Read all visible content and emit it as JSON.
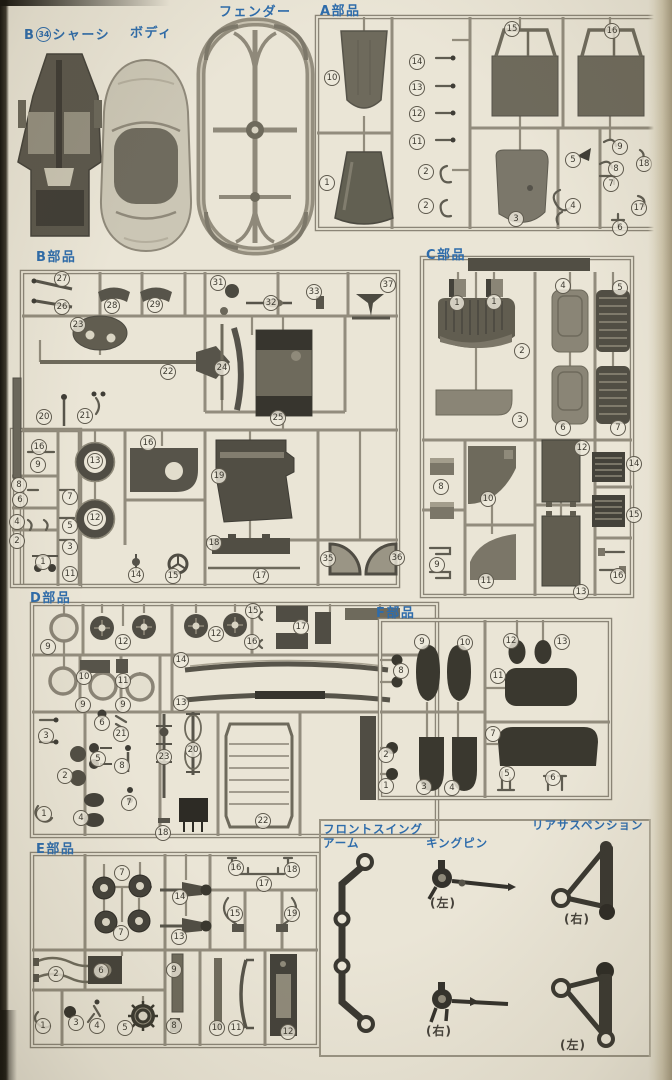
{
  "colors": {
    "paper": "#eae5d6",
    "runner": "#8b8577",
    "part_dark": "#4f4c44",
    "part_mid": "#767265",
    "label_blue": "#2e6cab",
    "caption_ink": "#45413a"
  },
  "header": {
    "chassis_prefix": "B",
    "chassis_number": "34",
    "chassis_name": "シャーシ",
    "body_label": "ボディ",
    "fender_label": "フェンダー"
  },
  "sections": [
    {
      "id": "A",
      "label": "A部品",
      "parts": [
        {
          "n": "10",
          "x": 332,
          "y": 78
        },
        {
          "n": "1",
          "x": 327,
          "y": 183
        },
        {
          "n": "14",
          "x": 417,
          "y": 62
        },
        {
          "n": "13",
          "x": 417,
          "y": 88
        },
        {
          "n": "12",
          "x": 417,
          "y": 114
        },
        {
          "n": "11",
          "x": 417,
          "y": 142
        },
        {
          "n": "2",
          "x": 426,
          "y": 172
        },
        {
          "n": "2",
          "x": 426,
          "y": 206
        },
        {
          "n": "15",
          "x": 512,
          "y": 29
        },
        {
          "n": "16",
          "x": 612,
          "y": 31
        },
        {
          "n": "3",
          "x": 516,
          "y": 219
        },
        {
          "n": "5",
          "x": 573,
          "y": 160
        },
        {
          "n": "9",
          "x": 620,
          "y": 147
        },
        {
          "n": "8",
          "x": 616,
          "y": 169
        },
        {
          "n": "18",
          "x": 644,
          "y": 164
        },
        {
          "n": "7",
          "x": 611,
          "y": 184
        },
        {
          "n": "4",
          "x": 573,
          "y": 206
        },
        {
          "n": "17",
          "x": 639,
          "y": 208
        },
        {
          "n": "6",
          "x": 620,
          "y": 228
        }
      ]
    },
    {
      "id": "B",
      "label": "B部品",
      "parts": [
        {
          "n": "27",
          "x": 62,
          "y": 279
        },
        {
          "n": "26",
          "x": 62,
          "y": 307
        },
        {
          "n": "28",
          "x": 112,
          "y": 306
        },
        {
          "n": "29",
          "x": 155,
          "y": 305
        },
        {
          "n": "31",
          "x": 218,
          "y": 283
        },
        {
          "n": "32",
          "x": 271,
          "y": 303
        },
        {
          "n": "33",
          "x": 314,
          "y": 292
        },
        {
          "n": "37",
          "x": 388,
          "y": 285
        },
        {
          "n": "23",
          "x": 78,
          "y": 325
        },
        {
          "n": "22",
          "x": 168,
          "y": 372
        },
        {
          "n": "24",
          "x": 222,
          "y": 368
        },
        {
          "n": "25",
          "x": 278,
          "y": 418
        },
        {
          "n": "20",
          "x": 44,
          "y": 417
        },
        {
          "n": "21",
          "x": 85,
          "y": 416
        },
        {
          "n": "16",
          "x": 39,
          "y": 447
        },
        {
          "n": "9",
          "x": 38,
          "y": 465
        },
        {
          "n": "8",
          "x": 19,
          "y": 485
        },
        {
          "n": "6",
          "x": 20,
          "y": 500
        },
        {
          "n": "4",
          "x": 17,
          "y": 522
        },
        {
          "n": "2",
          "x": 17,
          "y": 541
        },
        {
          "n": "1",
          "x": 43,
          "y": 562
        },
        {
          "n": "7",
          "x": 70,
          "y": 497
        },
        {
          "n": "5",
          "x": 70,
          "y": 526
        },
        {
          "n": "3",
          "x": 70,
          "y": 547
        },
        {
          "n": "13",
          "x": 95,
          "y": 461
        },
        {
          "n": "12",
          "x": 95,
          "y": 518
        },
        {
          "n": "11",
          "x": 70,
          "y": 574
        },
        {
          "n": "16",
          "x": 148,
          "y": 443
        },
        {
          "n": "14",
          "x": 136,
          "y": 575
        },
        {
          "n": "15",
          "x": 173,
          "y": 576
        },
        {
          "n": "19",
          "x": 219,
          "y": 476
        },
        {
          "n": "18",
          "x": 214,
          "y": 543
        },
        {
          "n": "17",
          "x": 261,
          "y": 576
        },
        {
          "n": "35",
          "x": 328,
          "y": 559
        },
        {
          "n": "36",
          "x": 397,
          "y": 558
        }
      ]
    },
    {
      "id": "C",
      "label": "C部品",
      "parts": [
        {
          "n": "1",
          "x": 457,
          "y": 303
        },
        {
          "n": "1",
          "x": 494,
          "y": 302
        },
        {
          "n": "2",
          "x": 522,
          "y": 351
        },
        {
          "n": "3",
          "x": 520,
          "y": 420
        },
        {
          "n": "4",
          "x": 563,
          "y": 286
        },
        {
          "n": "5",
          "x": 620,
          "y": 288
        },
        {
          "n": "6",
          "x": 563,
          "y": 428
        },
        {
          "n": "7",
          "x": 618,
          "y": 428
        },
        {
          "n": "8",
          "x": 441,
          "y": 487
        },
        {
          "n": "9",
          "x": 437,
          "y": 565
        },
        {
          "n": "10",
          "x": 488,
          "y": 499
        },
        {
          "n": "11",
          "x": 486,
          "y": 581
        },
        {
          "n": "12",
          "x": 582,
          "y": 448
        },
        {
          "n": "13",
          "x": 581,
          "y": 592
        },
        {
          "n": "14",
          "x": 634,
          "y": 464
        },
        {
          "n": "15",
          "x": 634,
          "y": 515
        },
        {
          "n": "16",
          "x": 618,
          "y": 576
        }
      ]
    },
    {
      "id": "D",
      "label": "D部品",
      "parts": [
        {
          "n": "9",
          "x": 48,
          "y": 647
        },
        {
          "n": "12",
          "x": 123,
          "y": 642
        },
        {
          "n": "12",
          "x": 216,
          "y": 634
        },
        {
          "n": "15",
          "x": 253,
          "y": 611
        },
        {
          "n": "17",
          "x": 301,
          "y": 627
        },
        {
          "n": "16",
          "x": 252,
          "y": 642
        },
        {
          "n": "14",
          "x": 181,
          "y": 660
        },
        {
          "n": "13",
          "x": 181,
          "y": 703
        },
        {
          "n": "10",
          "x": 84,
          "y": 677
        },
        {
          "n": "11",
          "x": 123,
          "y": 681
        },
        {
          "n": "9",
          "x": 83,
          "y": 705
        },
        {
          "n": "9",
          "x": 123,
          "y": 705
        },
        {
          "n": "3",
          "x": 46,
          "y": 736
        },
        {
          "n": "6",
          "x": 102,
          "y": 723
        },
        {
          "n": "21",
          "x": 121,
          "y": 734
        },
        {
          "n": "2",
          "x": 65,
          "y": 776
        },
        {
          "n": "5",
          "x": 98,
          "y": 759
        },
        {
          "n": "8",
          "x": 122,
          "y": 766
        },
        {
          "n": "7",
          "x": 129,
          "y": 803
        },
        {
          "n": "1",
          "x": 44,
          "y": 814
        },
        {
          "n": "4",
          "x": 81,
          "y": 818
        },
        {
          "n": "23",
          "x": 164,
          "y": 757
        },
        {
          "n": "20",
          "x": 193,
          "y": 750
        },
        {
          "n": "22",
          "x": 263,
          "y": 821
        },
        {
          "n": "18",
          "x": 163,
          "y": 833
        }
      ]
    },
    {
      "id": "F",
      "label": "F部品",
      "parts": [
        {
          "n": "9",
          "x": 422,
          "y": 642
        },
        {
          "n": "10",
          "x": 465,
          "y": 643
        },
        {
          "n": "8",
          "x": 401,
          "y": 671
        },
        {
          "n": "12",
          "x": 511,
          "y": 641
        },
        {
          "n": "13",
          "x": 562,
          "y": 642
        },
        {
          "n": "11",
          "x": 498,
          "y": 676
        },
        {
          "n": "2",
          "x": 386,
          "y": 755
        },
        {
          "n": "1",
          "x": 386,
          "y": 786
        },
        {
          "n": "3",
          "x": 424,
          "y": 787
        },
        {
          "n": "4",
          "x": 452,
          "y": 788
        },
        {
          "n": "7",
          "x": 493,
          "y": 734
        },
        {
          "n": "5",
          "x": 507,
          "y": 774
        },
        {
          "n": "6",
          "x": 553,
          "y": 778
        }
      ]
    },
    {
      "id": "E",
      "label": "E部品",
      "parts": [
        {
          "n": "7",
          "x": 122,
          "y": 873
        },
        {
          "n": "7",
          "x": 121,
          "y": 933
        },
        {
          "n": "14",
          "x": 180,
          "y": 897
        },
        {
          "n": "13",
          "x": 179,
          "y": 937
        },
        {
          "n": "16",
          "x": 236,
          "y": 868
        },
        {
          "n": "18",
          "x": 292,
          "y": 870
        },
        {
          "n": "17",
          "x": 264,
          "y": 884
        },
        {
          "n": "15",
          "x": 235,
          "y": 914
        },
        {
          "n": "19",
          "x": 292,
          "y": 914
        },
        {
          "n": "2",
          "x": 56,
          "y": 974
        },
        {
          "n": "6",
          "x": 101,
          "y": 971
        },
        {
          "n": "9",
          "x": 174,
          "y": 970
        },
        {
          "n": "1",
          "x": 43,
          "y": 1026
        },
        {
          "n": "3",
          "x": 76,
          "y": 1023
        },
        {
          "n": "4",
          "x": 97,
          "y": 1026
        },
        {
          "n": "5",
          "x": 125,
          "y": 1028
        },
        {
          "n": "8",
          "x": 174,
          "y": 1026
        },
        {
          "n": "10",
          "x": 217,
          "y": 1028
        },
        {
          "n": "11",
          "x": 236,
          "y": 1028
        },
        {
          "n": "12",
          "x": 288,
          "y": 1032
        }
      ]
    }
  ],
  "bottom_area": {
    "front_swing_arm": {
      "label_line1": "フロントスイング",
      "label_line2": "アーム"
    },
    "king_pin": {
      "label": "キングピン",
      "top_caption": "(左)",
      "bottom_caption": "(右)"
    },
    "rear_suspension": {
      "label": "リアサスペンション",
      "top_caption": "(右)",
      "bottom_caption": "(左)"
    }
  }
}
